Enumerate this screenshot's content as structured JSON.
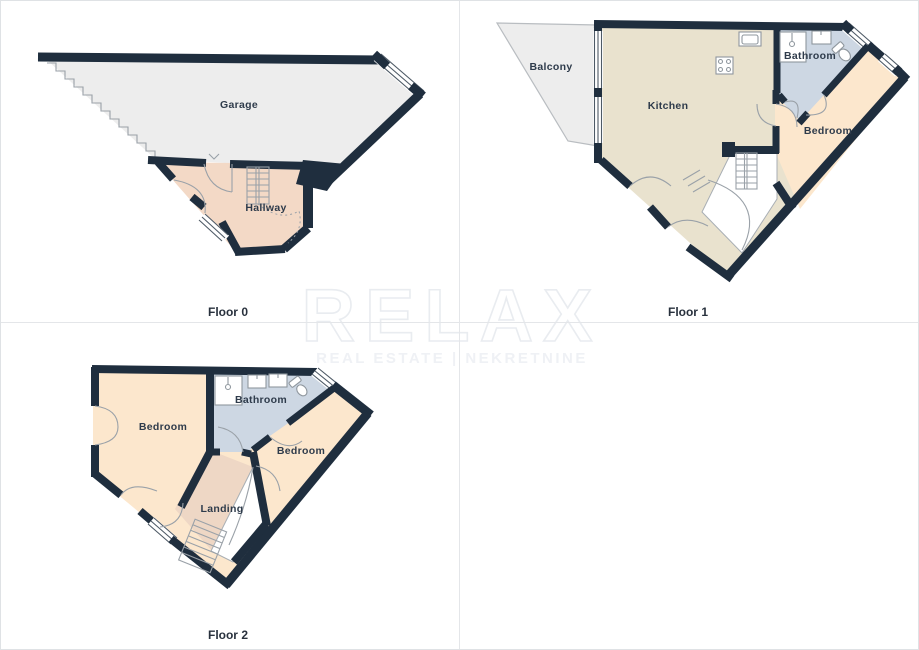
{
  "watermark": {
    "title": "RELAX",
    "subtitle": "REAL ESTATE | NEKRETNINE"
  },
  "palette": {
    "wall": "#1f2e3e",
    "garage": "#ededed",
    "balcony": "#ededed",
    "kitchen": "#e9e2ce",
    "bathroom": "#cdd7e3",
    "bedroom": "#fce7cd",
    "hallway": "#f3d9c6",
    "landing": "#eed7c5",
    "void": "#ffffff",
    "label": "#2e3b4b",
    "watermark": "#e9ecf0"
  },
  "floors": [
    {
      "id": "floor-0",
      "label": "Floor 0",
      "rooms": [
        {
          "name": "Garage"
        },
        {
          "name": "Hallway"
        }
      ]
    },
    {
      "id": "floor-1",
      "label": "Floor 1",
      "rooms": [
        {
          "name": "Balcony"
        },
        {
          "name": "Kitchen"
        },
        {
          "name": "Bathroom"
        },
        {
          "name": "Bedroom"
        }
      ]
    },
    {
      "id": "floor-2",
      "label": "Floor 2",
      "rooms": [
        {
          "name": "Bedroom"
        },
        {
          "name": "Bathroom"
        },
        {
          "name": "Bedroom"
        },
        {
          "name": "Landing"
        }
      ]
    }
  ]
}
